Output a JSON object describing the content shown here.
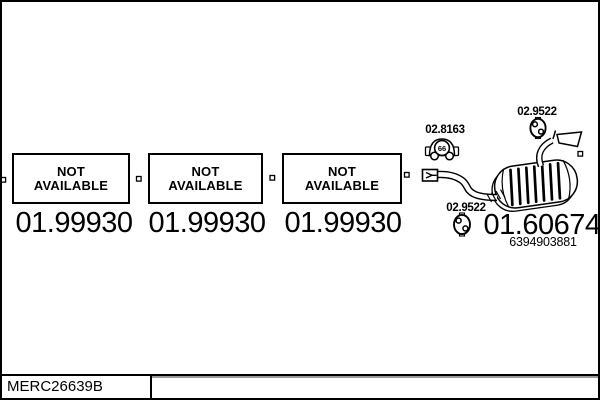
{
  "boxes": [
    {
      "line1": "NOT",
      "line2": "AVAILABLE",
      "number": "01.99930"
    },
    {
      "line1": "NOT",
      "line2": "AVAILABLE",
      "number": "01.99930"
    },
    {
      "line1": "NOT",
      "line2": "AVAILABLE",
      "number": "01.99930"
    }
  ],
  "muffler": {
    "mount_label": "02.8163",
    "mount_icon_text": "66",
    "clamp_top_label": "02.9522",
    "clamp_bottom_label": "02.9522",
    "number": "01.60674",
    "oem_number": "6394903881"
  },
  "footer": {
    "code": "MERC26639B"
  },
  "colors": {
    "line": "#000000",
    "background": "#ffffff",
    "shadow": "#9a9a9a"
  }
}
